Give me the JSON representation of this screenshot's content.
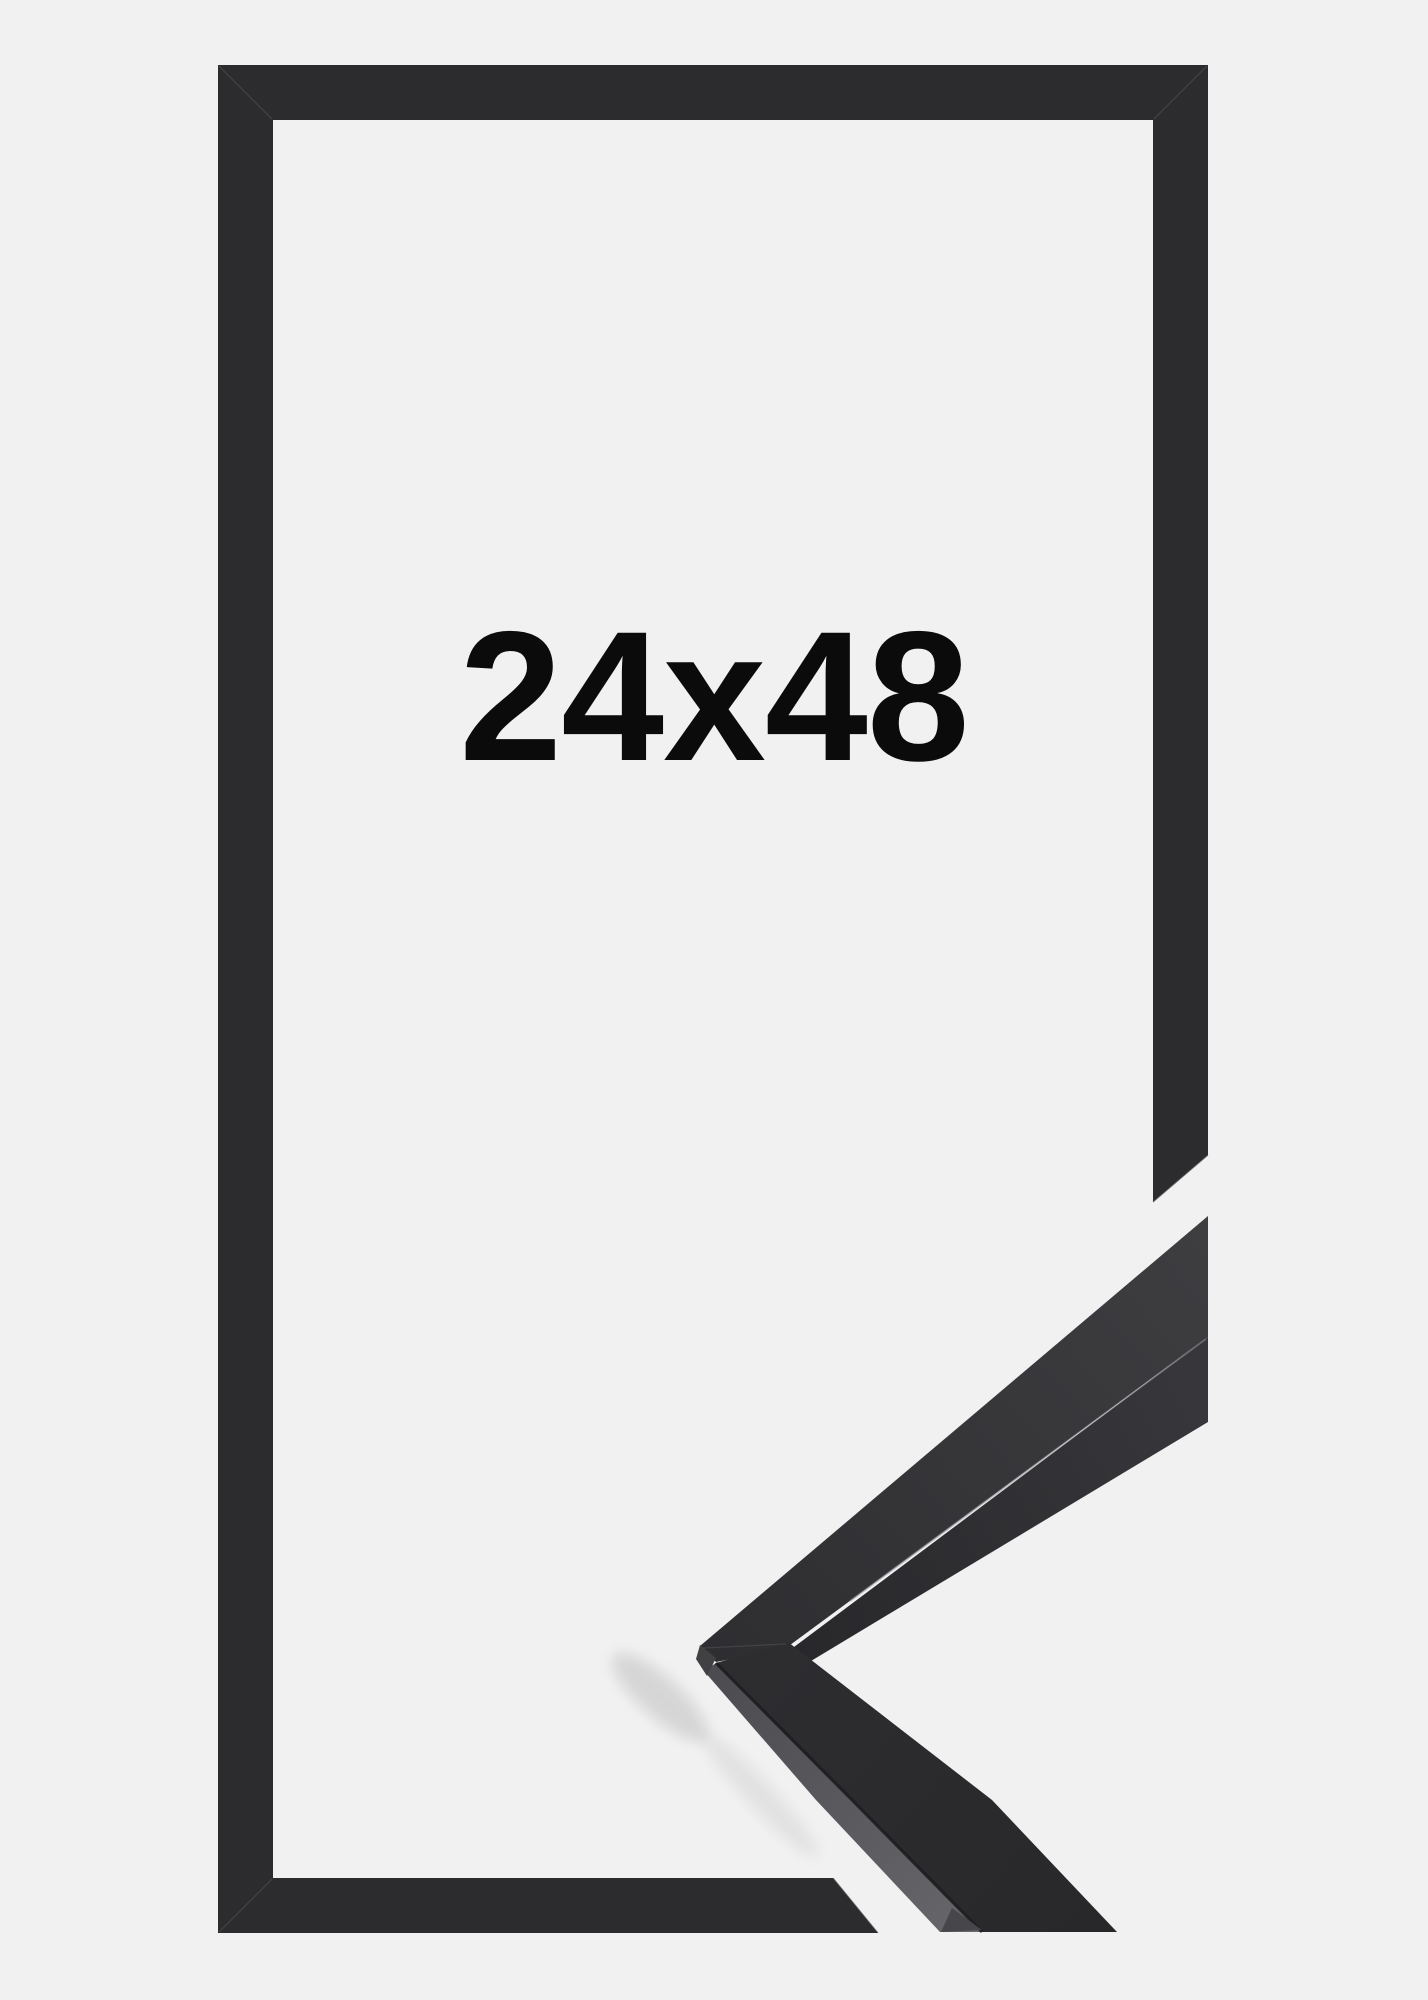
{
  "frame_photo": {
    "size_label": "24x48",
    "colors": {
      "background": "#f1f1f2",
      "frame": "#2c2c2e",
      "label_text": "#0b0b0b",
      "sample_top_face_near": "#2e2e31",
      "sample_top_face_far": "#3e3e41",
      "sample_side_dark": "#28282b",
      "sample_side_light": "#5b5b5f",
      "arris_highlight": "#8a8a8f",
      "arris_shadow": "#1a1a1c",
      "miter_seam": "#59595e"
    }
  }
}
